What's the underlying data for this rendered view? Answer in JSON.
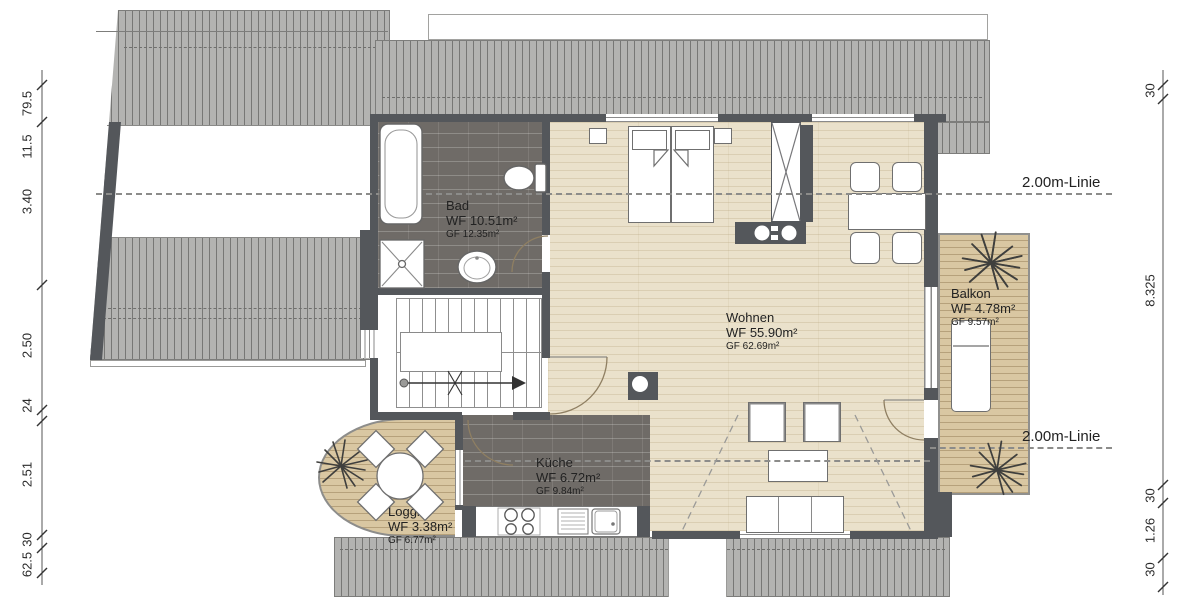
{
  "rooms": {
    "bad": {
      "name": "Bad",
      "wf": "WF 10.51m²",
      "gf": "GF 12.35m²"
    },
    "wohnen": {
      "name": "Wohnen",
      "wf": "WF 55.90m²",
      "gf": "GF 62.69m²"
    },
    "kueche": {
      "name": "Küche",
      "wf": "WF 6.72m²",
      "gf": "GF 9.84m²"
    },
    "loggia": {
      "name": "Loggia",
      "wf": "WF 3.38m²",
      "gf": "GF 6.77m²"
    },
    "balkon": {
      "name": "Balkon",
      "wf": "WF 4.78m²",
      "gf": "GF 9.57m²"
    }
  },
  "annotations": {
    "linie_top": "2.00m-Linie",
    "linie_bottom": "2.00m-Linie"
  },
  "dimensions": {
    "left": [
      "79.5",
      "11.5",
      "3.40",
      "2.50",
      "24",
      "2.51",
      "30",
      "62.5"
    ],
    "right": [
      "30",
      "8.325",
      "30",
      "1.26",
      "30"
    ]
  },
  "colors": {
    "wall": "#54575b",
    "tile_floor": "#6f6b67",
    "wood_floor": "#eae1cb",
    "deck_floor": "#d9c7a2",
    "roof_hatch": "#b3b3b1",
    "dash_line": "#8c8c8a"
  }
}
